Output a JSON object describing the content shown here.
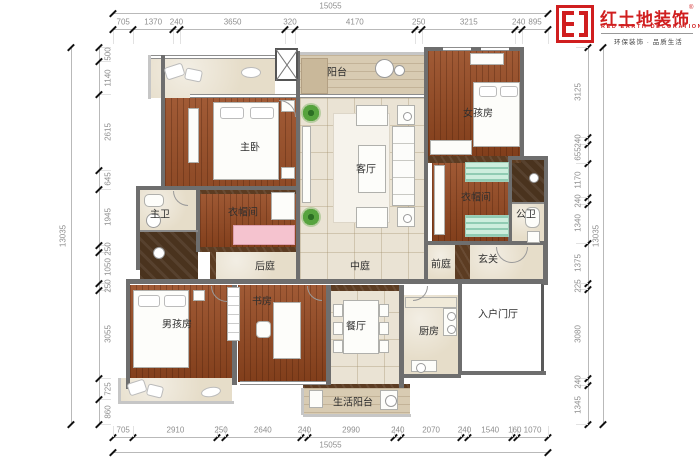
{
  "logo": {
    "brand": "红土地装饰",
    "reg": "®",
    "brand_en": "RED EARTH DECORATION",
    "tagline": "环保装饰 · 品质生活"
  },
  "rooms": {
    "balcony": "阳台",
    "master_bedroom": "主卧",
    "girl_room": "女孩房",
    "living_room": "客厅",
    "cloak_left": "衣帽间",
    "cloak_right": "衣帽间",
    "master_bath": "主卫",
    "public_bath": "公卫",
    "back_court": "后庭",
    "mid_court": "中庭",
    "front_court": "前庭",
    "entry": "玄关",
    "boy_room": "男孩房",
    "study": "书房",
    "dining": "餐厅",
    "kitchen": "厨房",
    "entry_hall": "入户门厅",
    "service_balcony": "生活阳台"
  },
  "dimensions": {
    "top": {
      "total": "15055",
      "segments": [
        705,
        1370,
        240,
        3650,
        320,
        4170,
        250,
        3215,
        240,
        895
      ]
    },
    "bottom": {
      "total": "15055",
      "segments": [
        705,
        2910,
        250,
        2640,
        240,
        2990,
        240,
        2070,
        240,
        1540,
        160,
        1070
      ]
    },
    "left": {
      "total": "13035",
      "segments": [
        500,
        1140,
        2615,
        645,
        1945,
        250,
        1050,
        250,
        3055,
        725,
        860
      ]
    },
    "right": {
      "total": "13035",
      "segments": [
        3125,
        240,
        655,
        1170,
        240,
        1340,
        1375,
        225,
        3080,
        240,
        1345
      ]
    }
  },
  "colors": {
    "accent_red": "#d01e1f",
    "wood": "#96481f",
    "tile": "#eae3d4",
    "dark_marble": "#4a331e",
    "wall_gray": "#6e6e6e",
    "cabinet_teal": "#cdeedd",
    "chaise_pink": "#f5c3cf"
  }
}
